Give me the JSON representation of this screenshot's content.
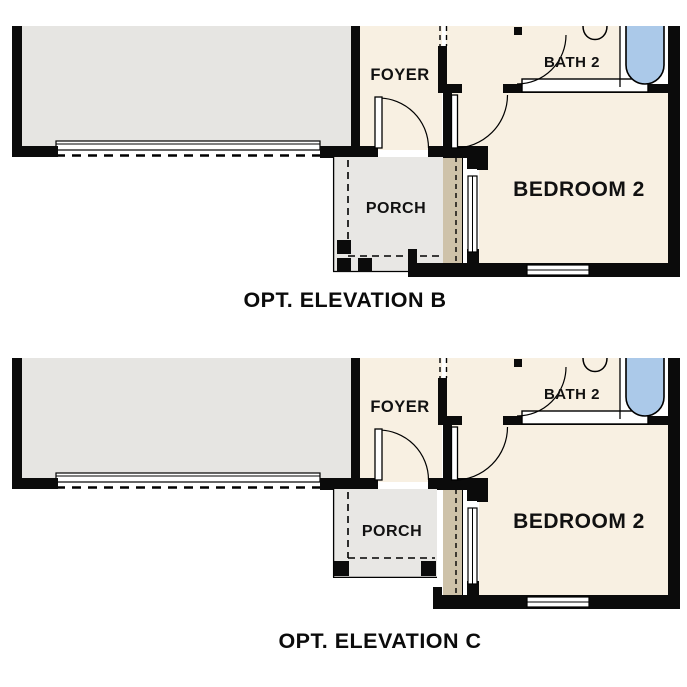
{
  "figure": {
    "background": "#ffffff",
    "description": "Optional elevation floor plan comparison"
  },
  "colors": {
    "wall_black": "#0b0b0b",
    "room_cream": "#f8f0e2",
    "garage_gray": "#e6e5e2",
    "porch_gray": "#e8e7e4",
    "accent_tan": "#cec2a9",
    "tub_blue": "#abc9e9",
    "label_color": "#111111"
  },
  "plans": [
    {
      "id": "opt-elevation-b",
      "caption": "OPT. ELEVATION B",
      "labels": {
        "foyer": "FOYER",
        "bath": "BATH 2",
        "bedroom": "BEDROOM 2",
        "porch": "PORCH"
      }
    },
    {
      "id": "opt-elevation-c",
      "caption": "OPT. ELEVATION C",
      "labels": {
        "foyer": "FOYER",
        "bath": "BATH 2",
        "bedroom": "BEDROOM 2",
        "porch": "PORCH"
      }
    }
  ]
}
